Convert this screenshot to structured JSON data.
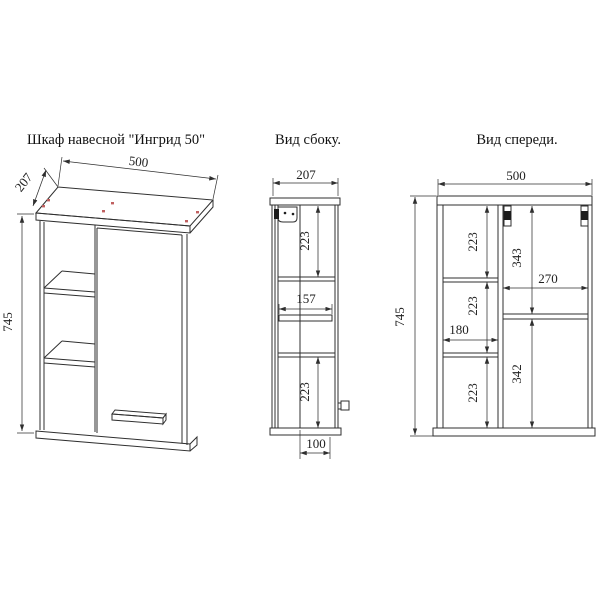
{
  "colors": {
    "background": "#ffffff",
    "line": "#2f2f2f",
    "text": "#1f1f1f",
    "fastener_mark": "#c06060"
  },
  "views": {
    "isometric": {
      "title": "Шкаф навесной \"Ингрид 50\"",
      "dim_width": "500",
      "dim_depth": "207",
      "dim_height": "745"
    },
    "side": {
      "title": "Вид сбоку.",
      "dim_depth": "207",
      "dim_top_section": "223",
      "dim_shelf_depth": "157",
      "dim_bottom_section": "223",
      "dim_handle_offset": "100"
    },
    "front": {
      "title": "Вид спереди.",
      "dim_width": "500",
      "dim_height": "745",
      "dim_left_top": "223",
      "dim_left_middle": "223",
      "dim_left_bottom": "223",
      "dim_shelf_width": "180",
      "dim_door_top": "343",
      "dim_door_opening_width": "270",
      "dim_door_bottom": "342"
    }
  }
}
